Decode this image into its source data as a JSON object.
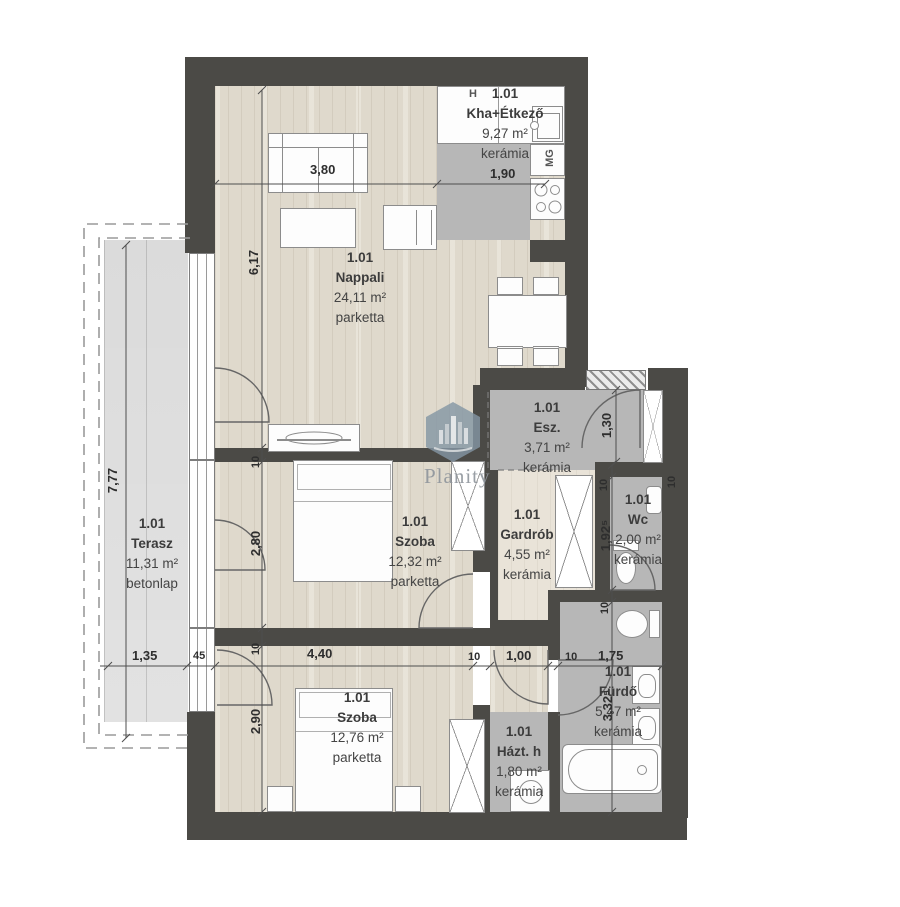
{
  "plan": {
    "watermark": {
      "brand": "Planity"
    },
    "rooms": [
      {
        "id": "1.01",
        "name": "Kha+Étkező",
        "area": "9,27 m²",
        "floor": "kerámia"
      },
      {
        "id": "1.01",
        "name": "Nappali",
        "area": "24,11 m²",
        "floor": "parketta"
      },
      {
        "id": "1.01",
        "name": "Terasz",
        "area": "11,31 m²",
        "floor": "betonlap"
      },
      {
        "id": "1.01",
        "name": "Szoba",
        "area": "12,32 m²",
        "floor": "parketta"
      },
      {
        "id": "1.01",
        "name": "Gardrób",
        "area": "4,55 m²",
        "floor": "kerámia"
      },
      {
        "id": "1.01",
        "name": "Esz.",
        "area": "3,71 m²",
        "floor": "kerámia"
      },
      {
        "id": "1.01",
        "name": "Wc",
        "area": "2,00 m²",
        "floor": "kerámia"
      },
      {
        "id": "1.01",
        "name": "Fürdő",
        "area": "5,47 m²",
        "floor": "kerámia"
      },
      {
        "id": "1.01",
        "name": "Házt. h",
        "area": "1,80 m²",
        "floor": "kerámia"
      },
      {
        "id": "1.01",
        "name": "Szoba",
        "area": "12,76 m²",
        "floor": "parketta"
      }
    ],
    "dimensions": {
      "nappali_width": "3,80",
      "kitchen_width": "1,90",
      "nappali_height": "6,17",
      "terasz_height": "7,77",
      "terasz_width": "1,35",
      "wall_45": "45",
      "wall_10": "10",
      "szoba1_height": "2,80",
      "szoba2_height": "2,90",
      "szoba2_width": "4,40",
      "hall_width": "1,00",
      "furdo_width": "1,75",
      "entry_depth": "1,30",
      "wc_height": "1,92⁵",
      "furdo_height": "3,32⁵"
    },
    "appliances": {
      "fridge": "H",
      "dishwasher": "MG"
    },
    "colors": {
      "wall": "#4b4a46",
      "parquet": "#e3ddd0",
      "ceramic": "#b7b7b7",
      "terrace": "#e2e2e2",
      "watermark": "#8496a4"
    }
  }
}
